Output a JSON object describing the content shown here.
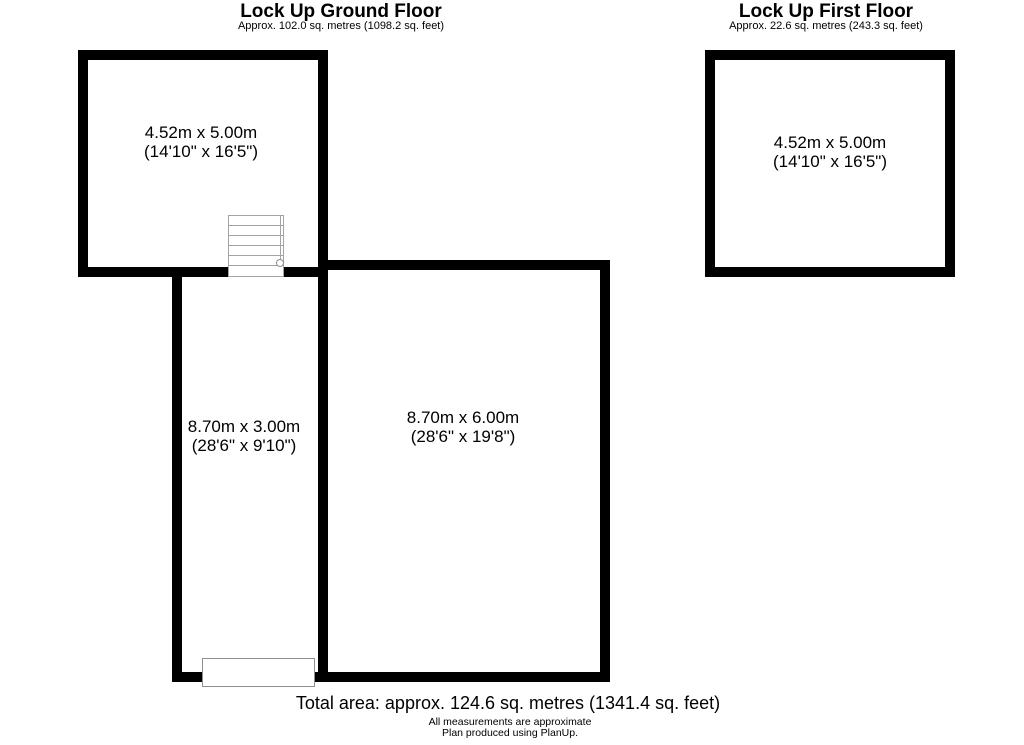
{
  "page": {
    "background": "#ffffff",
    "wall_color": "#000000",
    "stairs_outline_color": "#a3a3a3",
    "door_outline_color": "#8f8f8f"
  },
  "ground_floor": {
    "title": "Lock Up Ground Floor",
    "subtitle": "Approx. 102.0 sq. metres (1098.2 sq. feet)",
    "rooms": {
      "top": {
        "metric": "4.52m x 5.00m",
        "imperial": "(14'10\" x 16'5\")"
      },
      "left": {
        "metric": "8.70m x 3.00m",
        "imperial": "(28'6\" x 9'10\")"
      },
      "main": {
        "metric": "8.70m x 6.00m",
        "imperial": "(28'6\" x 19'8\")"
      }
    }
  },
  "first_floor": {
    "title": "Lock Up First Floor",
    "subtitle": "Approx. 22.6 sq. metres (243.3 sq. feet)",
    "rooms": {
      "main": {
        "metric": "4.52m x 5.00m",
        "imperial": "(14'10\" x 16'5\")"
      }
    }
  },
  "footer": {
    "total_area": "Total area: approx. 124.6 sq. metres (1341.4 sq. feet)",
    "disclaimer": "All measurements are approximate",
    "credit": "Plan produced using PlanUp."
  }
}
